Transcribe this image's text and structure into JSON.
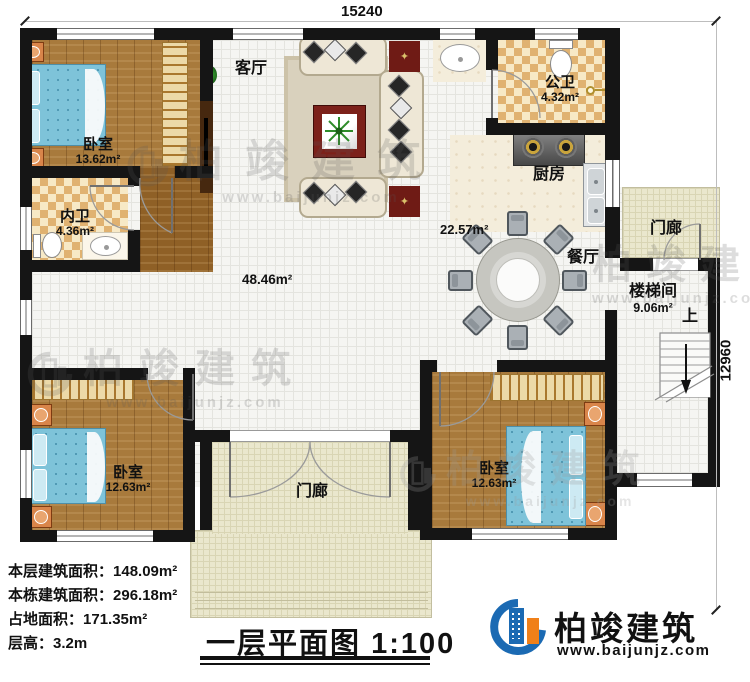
{
  "dimensions": {
    "top": "15240",
    "right": "12960"
  },
  "rooms": {
    "living": {
      "label": "客厅"
    },
    "bedroom_tl": {
      "label": "卧室",
      "area": "13.62m²"
    },
    "bath_inner": {
      "label": "内卫",
      "area": "4.36m²"
    },
    "bath_public": {
      "label": "公卫",
      "area": "4.32m²"
    },
    "kitchen": {
      "label": "厨房"
    },
    "dining": {
      "label": "餐厅",
      "area": "22.57m²"
    },
    "hall": {
      "area": "48.46m²"
    },
    "stair": {
      "label": "楼梯间",
      "area": "9.06m²",
      "up": "上"
    },
    "porch_right": {
      "label": "门廊"
    },
    "porch_front": {
      "label": "门廊"
    },
    "bedroom_bl": {
      "label": "卧室",
      "area": "12.63m²"
    },
    "bedroom_br": {
      "label": "卧室",
      "area": "12.63m²"
    }
  },
  "stats": [
    {
      "label": "本层建筑面积：",
      "value": "148.09m²"
    },
    {
      "label": "本栋建筑面积：",
      "value": "296.18m²"
    },
    {
      "label": "占地面积：",
      "value": "171.35m²"
    },
    {
      "label": "层高：",
      "value": "3.2m"
    }
  ],
  "title": {
    "name": "一层平面图",
    "scale": "1:100"
  },
  "brand": {
    "name": "柏竣建筑",
    "url": "www.baijunjz.com"
  },
  "watermark": {
    "name": "柏竣建筑",
    "url": "www.baijunjz.com"
  },
  "colors": {
    "wall": "#151515",
    "accent_blue": "#1b6ab3",
    "accent_orange": "#f08019",
    "bed": "#7ec3d9",
    "wood": "#a87a3c"
  }
}
